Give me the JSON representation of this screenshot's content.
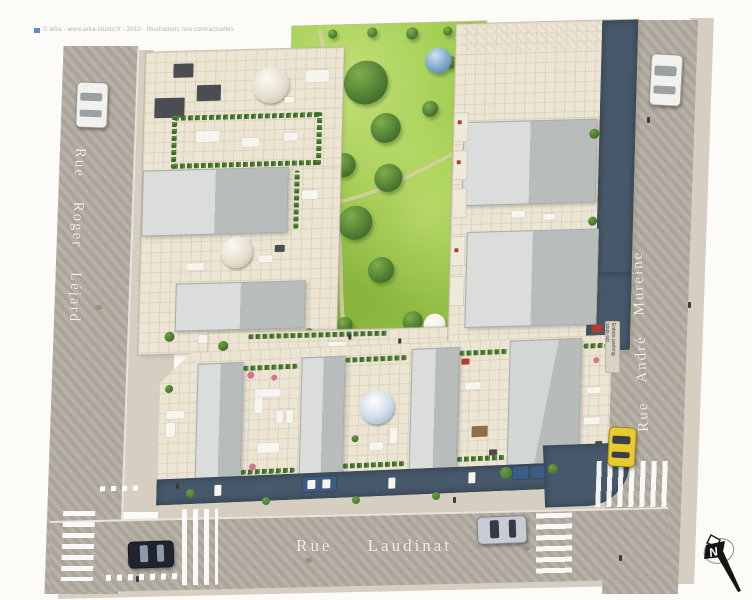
{
  "credit": "© arka - www.arka-studio.fr - 2010 - Illustrations non contractuelles",
  "streets": {
    "left": "Rue Roger Léjard",
    "right": "Rue André Mureine",
    "bottom": "Rue Laudinat"
  },
  "signs": {
    "parking_entrance": "Entrée parking sous-sol"
  },
  "compass": {
    "north_label": "N"
  },
  "colors": {
    "road": "#b4ada2",
    "sidewalk": "#d5cec1",
    "lawn": "#9ccb4b",
    "tree": "#4e7c33",
    "tree_blue": "#7da6c8",
    "tree_purple": "#b79fd4",
    "parasol": "#f1ede2",
    "terrace": "#ece5d4",
    "roof": "#c6cbc9",
    "facade": "#46586a",
    "crosswalk": "#ffffff",
    "car_white": "#f2f1ed",
    "car_black": "#20242e",
    "car_silver": "#c9ccd2",
    "car_yellow": "#e8c92e",
    "car_blue": "#3c5c86"
  }
}
